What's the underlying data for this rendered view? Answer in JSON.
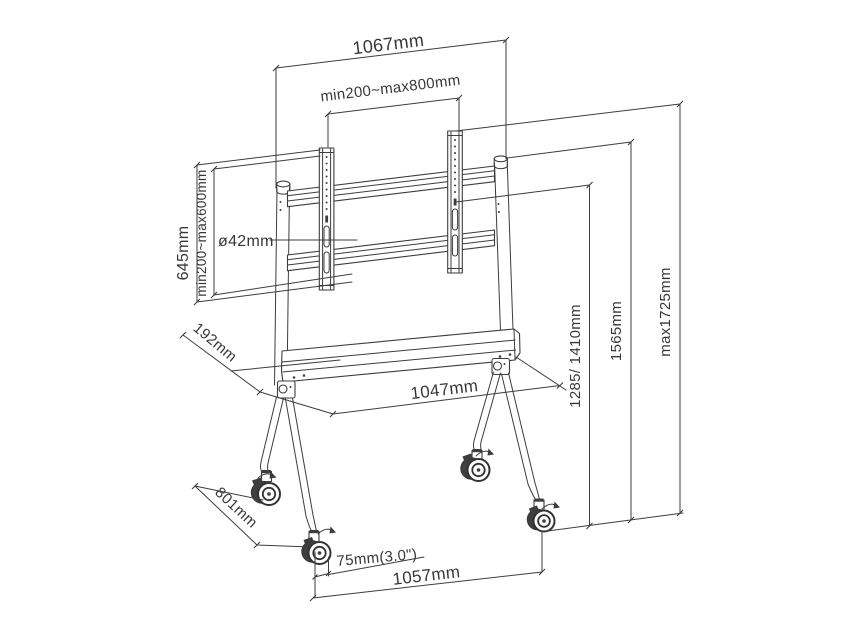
{
  "diagram": {
    "labels": {
      "width_top": "1067mm",
      "vesa_width_range": "min200~max800mm",
      "bracket_height": "645mm",
      "vesa_height_range": "min200~max600mm",
      "pole_diameter": "ø42mm",
      "shelf_depth": "192mm",
      "shelf_width": "1047mm",
      "mount_heights": "1285/ 1410mm",
      "column_height": "1565mm",
      "max_height": "max1725mm",
      "base_depth": "801mm",
      "caster_size": "75mm(3.0\")",
      "base_width": "1057mm"
    },
    "colors": {
      "line": "#3d3d3d",
      "text": "#383838",
      "background": "#ffffff",
      "wheel": "#3f3f3f"
    }
  }
}
